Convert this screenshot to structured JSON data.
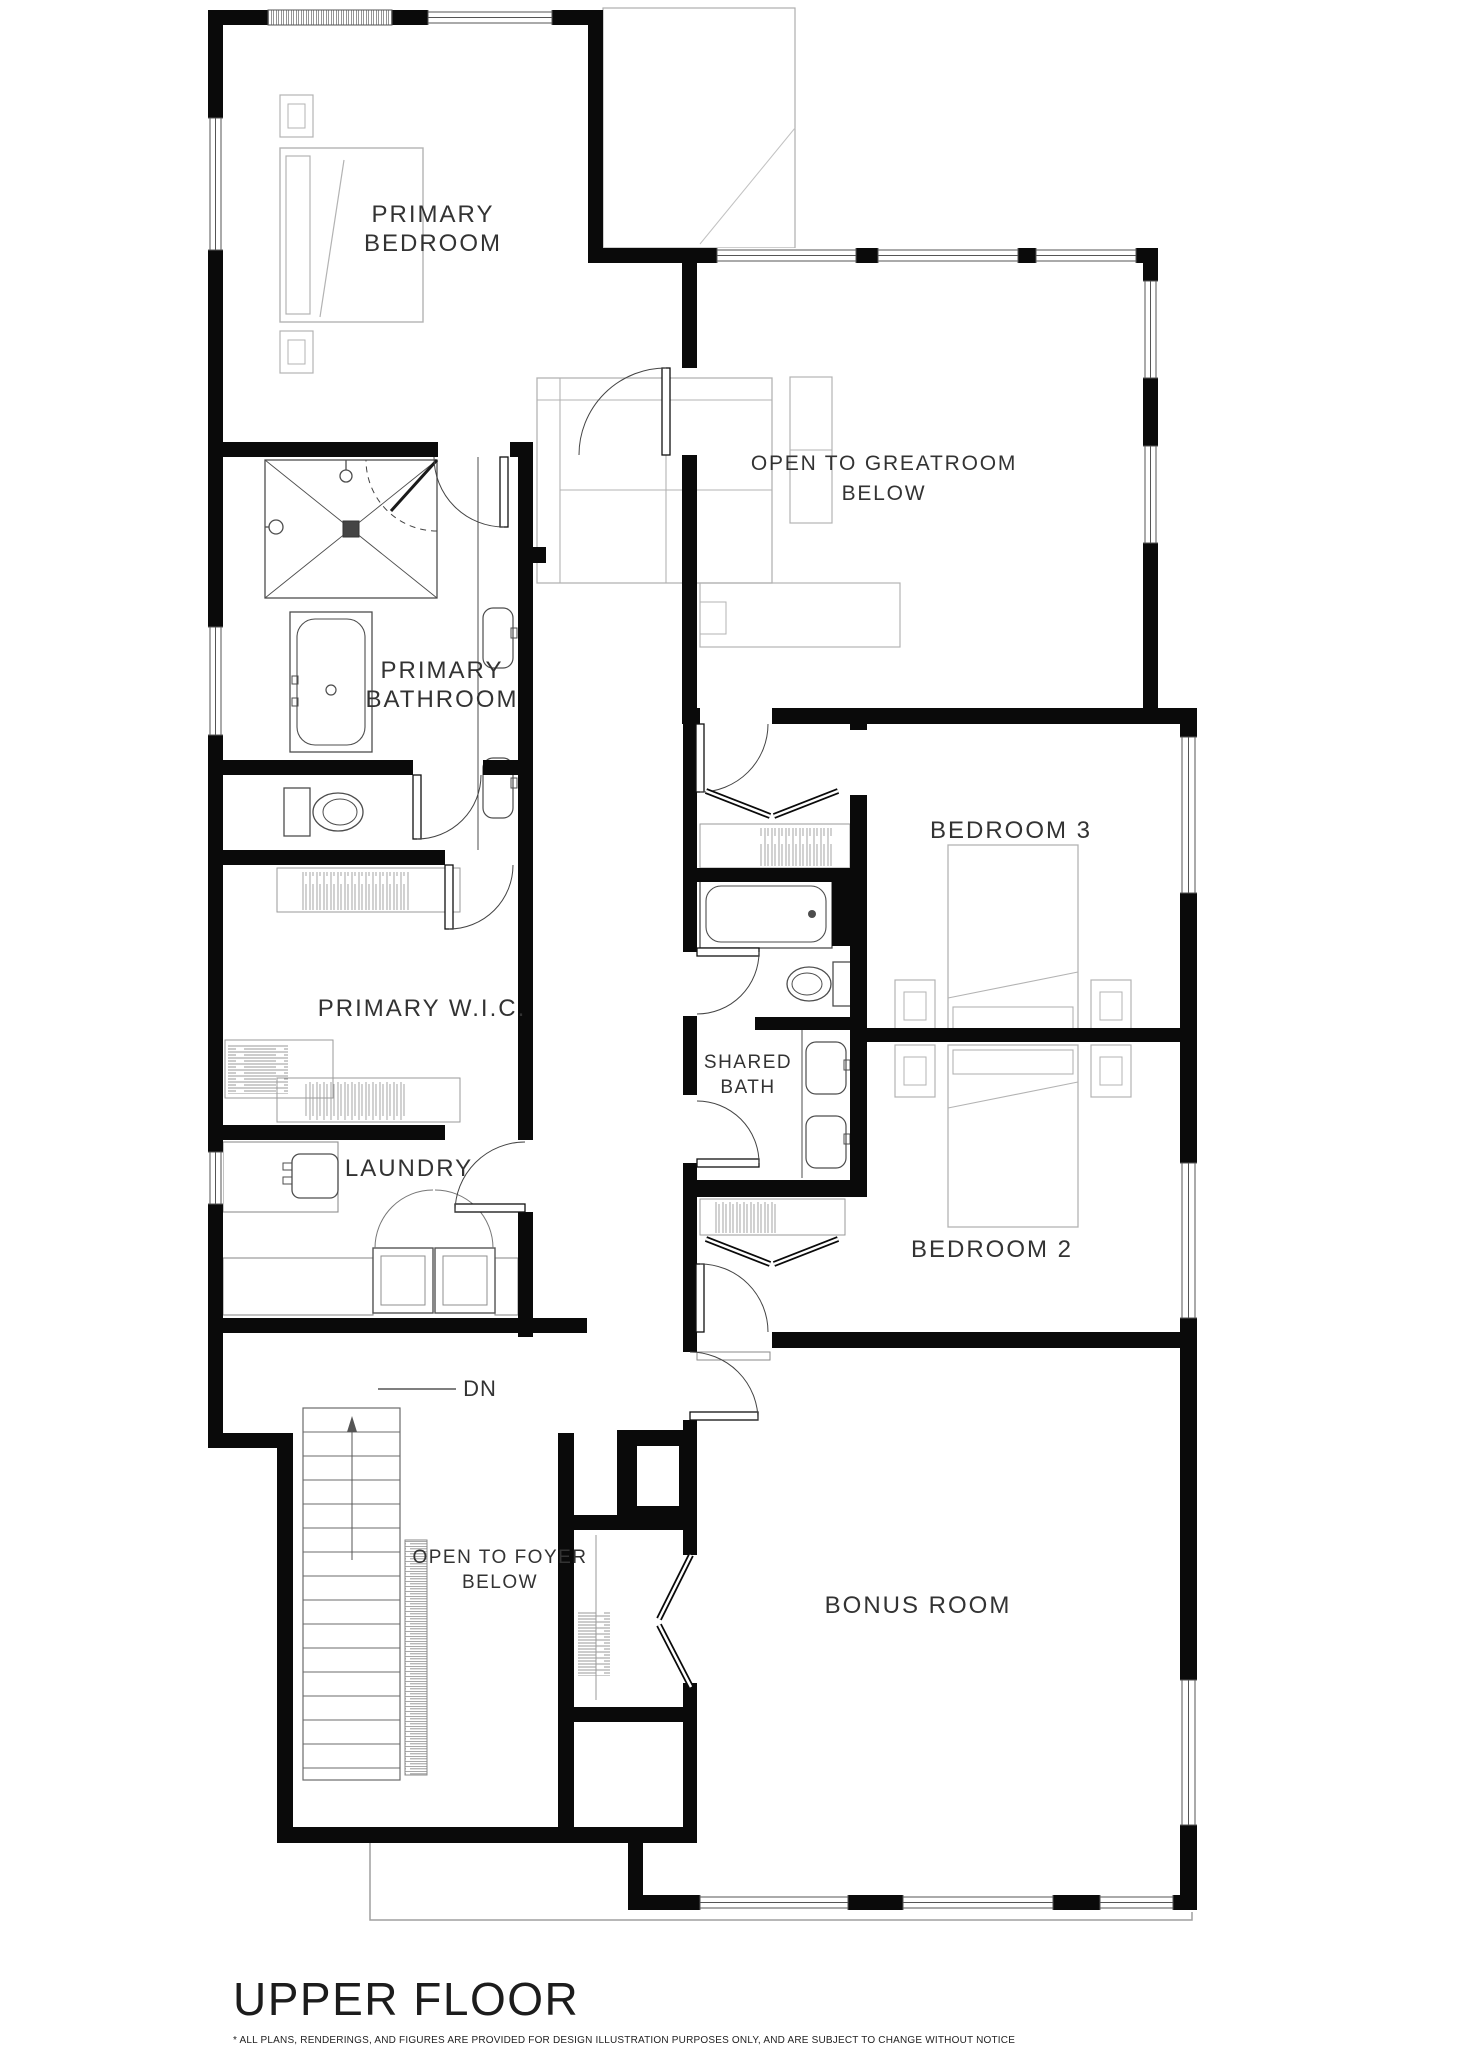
{
  "plan": {
    "title": "UPPER FLOOR",
    "disclaimer": "* ALL PLANS, RENDERINGS, AND FIGURES ARE PROVIDED FOR DESIGN ILLUSTRATION PURPOSES ONLY, AND ARE SUBJECT TO CHANGE WITHOUT NOTICE",
    "rooms": {
      "primary_bedroom": {
        "line1": "PRIMARY",
        "line2": "BEDROOM"
      },
      "open_to_greatroom": {
        "line1": "OPEN TO GREATROOM",
        "line2": "BELOW"
      },
      "primary_bathroom": {
        "line1": "PRIMARY",
        "line2": "BATHROOM"
      },
      "bedroom_3": {
        "label": "BEDROOM 3"
      },
      "primary_wic": {
        "label": "PRIMARY W.I.C."
      },
      "shared_bath": {
        "line1": "SHARED",
        "line2": "BATH"
      },
      "laundry": {
        "label": "LAUNDRY"
      },
      "bedroom_2": {
        "label": "BEDROOM 2"
      },
      "stairs": {
        "label": "DN"
      },
      "open_to_foyer": {
        "line1": "OPEN TO FOYER",
        "line2": "BELOW"
      },
      "bonus_room": {
        "label": "BONUS ROOM"
      }
    },
    "colors": {
      "wall": "#0a0a0a",
      "furniture": "#b3b3b3",
      "fixture": "#4d4d4d",
      "text": "#333333"
    }
  }
}
